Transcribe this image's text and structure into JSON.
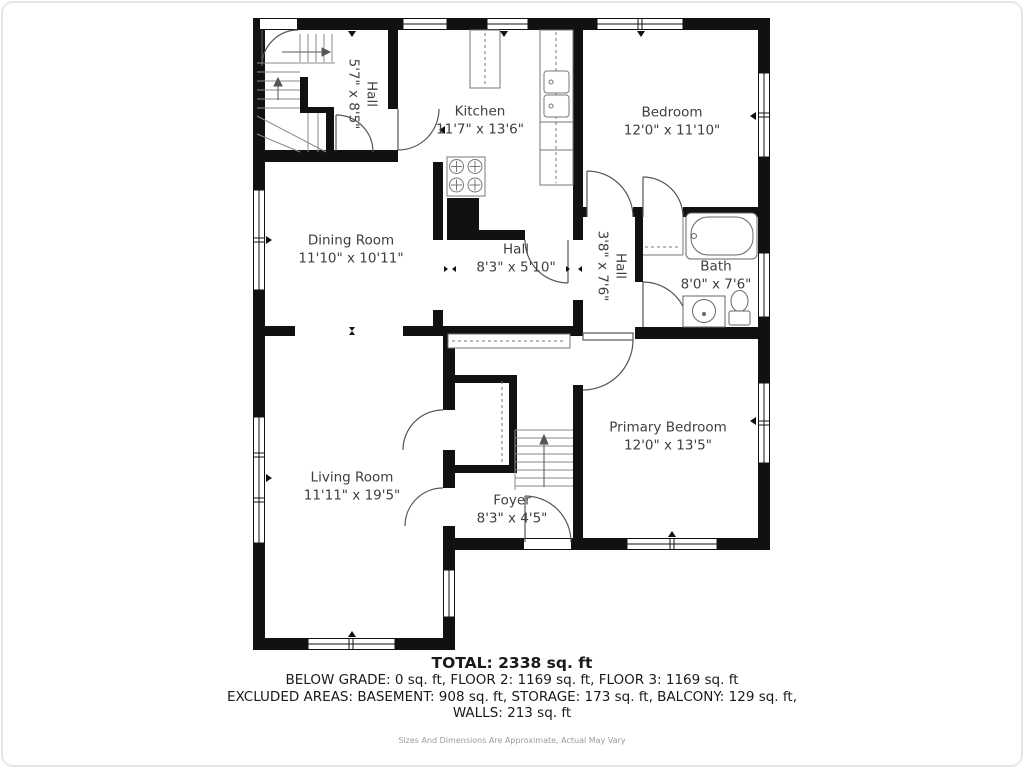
{
  "rooms": [
    {
      "name": "Hall",
      "dims": "5'7\" x 8'5\""
    },
    {
      "name": "Kitchen",
      "dims": "11'7\" x 13'6\""
    },
    {
      "name": "Bedroom",
      "dims": "12'0\" x 11'10\""
    },
    {
      "name": "Dining Room",
      "dims": "11'10\" x 10'11\""
    },
    {
      "name": "Hall",
      "dims": "8'3\" x 5'10\""
    },
    {
      "name": "Hall",
      "dims": "3'8\" x 7'6\""
    },
    {
      "name": "Bath",
      "dims": "8'0\" x 7'6\""
    },
    {
      "name": "Living Room",
      "dims": "11'11\" x 19'5\""
    },
    {
      "name": "Primary Bedroom",
      "dims": "12'0\" x 13'5\""
    },
    {
      "name": "Foyer",
      "dims": "8'3\" x 4'5\""
    }
  ],
  "summary": {
    "total": "TOTAL: 2338 sq. ft",
    "line2": "BELOW GRADE: 0 sq. ft, FLOOR 2: 1169 sq. ft, FLOOR 3: 1169 sq. ft",
    "line3": "EXCLUDED AREAS: BASEMENT: 908 sq. ft, STORAGE: 173 sq. ft, BALCONY: 129 sq. ft,",
    "line4": "WALLS: 213 sq. ft",
    "disclaimer": "Sizes And Dimensions Are Approximate, Actual May Vary"
  },
  "colors": {
    "wall": "#111111",
    "label": "#3f3f3f",
    "fixture": "#666666"
  }
}
